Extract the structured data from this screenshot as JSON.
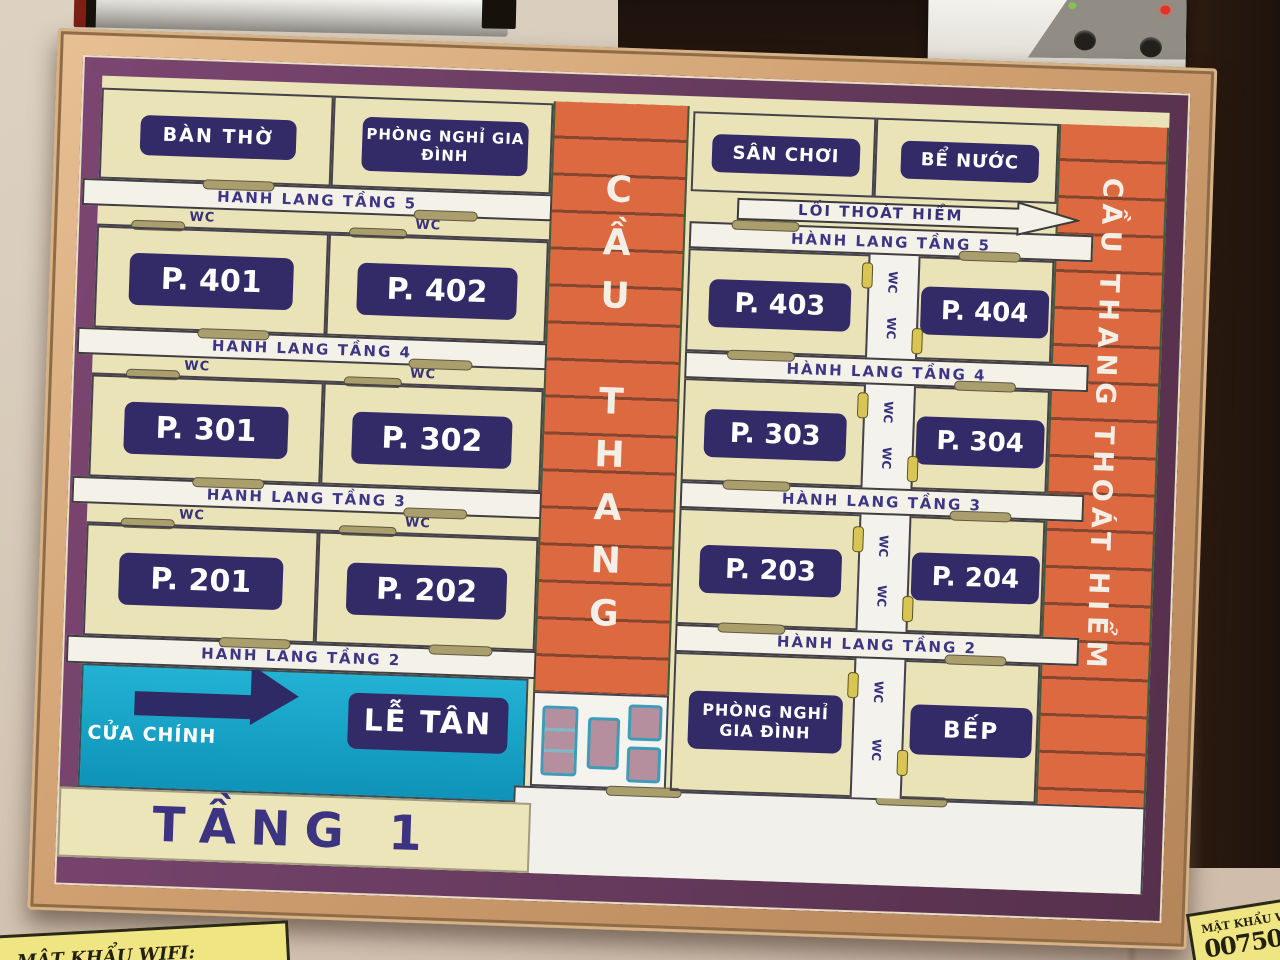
{
  "sign": {
    "floor_title": "TẦNG 1",
    "center_stair_label": "CẦU THANG",
    "right_stair_label": "CẦU THANG THOÁT HIỂM",
    "exit_arrow_label": "LỐI THOÁT HIỂM",
    "wc_label": "WC",
    "left_wing": {
      "top_rooms": [
        "BÀN THỜ",
        "PHÒNG NGHỈ GIA ĐÌNH"
      ],
      "floors": [
        {
          "hall": "HÀNH LANG TẦNG 5",
          "rooms": [
            "P. 401",
            "P. 402"
          ]
        },
        {
          "hall": "HÀNH LANG TẦNG 4",
          "rooms": [
            "P. 301",
            "P. 302"
          ]
        },
        {
          "hall": "HÀNH LANG TẦNG 3",
          "rooms": [
            "P. 201",
            "P. 202"
          ]
        },
        {
          "hall": "HÀNH LANG TẦNG 2"
        }
      ],
      "entrance_label": "CỬA CHÍNH",
      "reception_label": "LỄ TÂN"
    },
    "right_wing": {
      "top_rooms": [
        "SÂN CHƠI",
        "BỂ NƯỚC"
      ],
      "floors": [
        {
          "hall": "HÀNH LANG TẦNG 5",
          "rooms": [
            "P. 403",
            "P. 404"
          ]
        },
        {
          "hall": "HÀNH LANG TẦNG 4",
          "rooms": [
            "P. 303",
            "P. 304"
          ]
        },
        {
          "hall": "HÀNH LANG TẦNG 3",
          "rooms": [
            "P. 203",
            "P. 204"
          ]
        },
        {
          "hall": "HÀNH LANG TẦNG 2",
          "rooms": [
            "PHÒNG NGHỈ GIA ĐÌNH",
            "BẾP"
          ]
        }
      ]
    },
    "colors": {
      "frame_copper": "#cf9f70",
      "mat_purple": "#693c60",
      "board_cream": "#eae3b7",
      "stair_orange": "#dd6940",
      "badge_navy": "#322b68",
      "entrance_cyan": "#17a6c9",
      "hall_text": "#3d3684"
    }
  },
  "surroundings": {
    "wifi_note_left": "MẬT KHẨU WIFI:",
    "wifi_note_right_line1": "MẬT KHẨU W",
    "wifi_note_right_line2": "007505"
  }
}
